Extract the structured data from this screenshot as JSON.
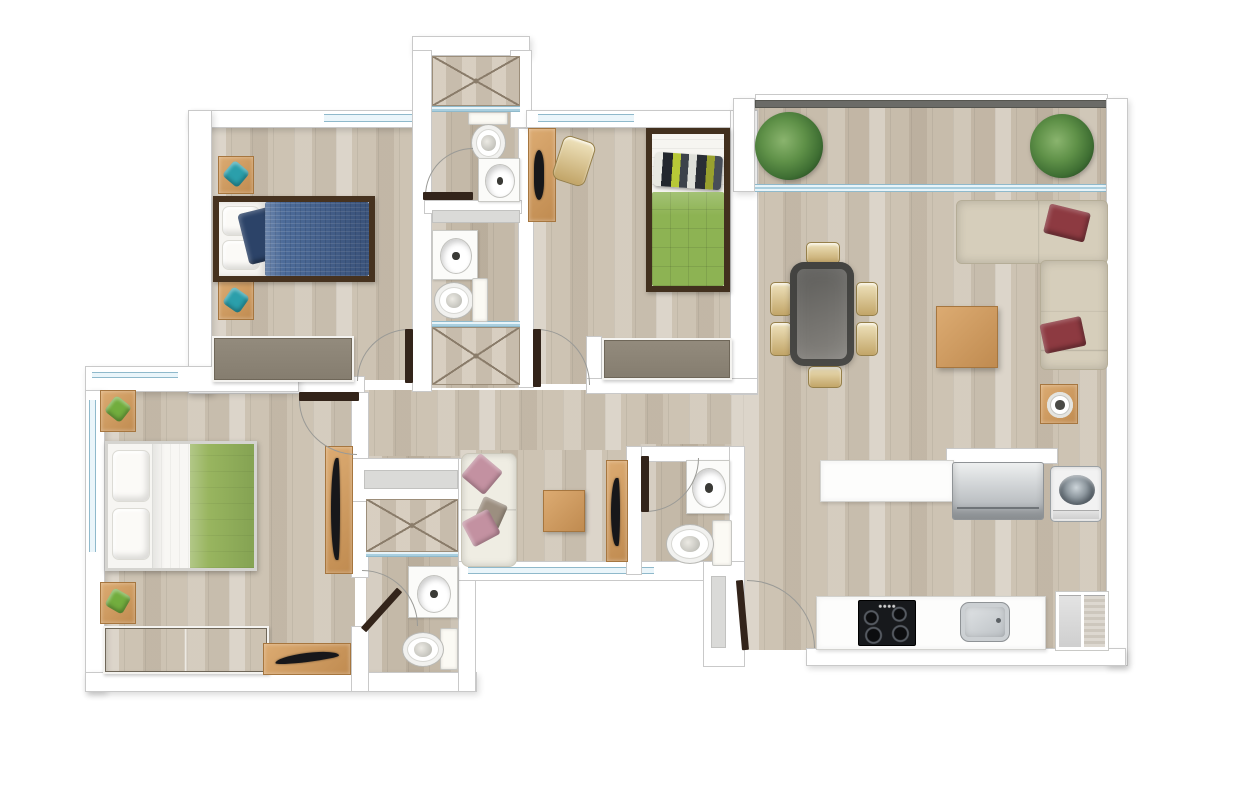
{
  "scene": {
    "type": "apartment-floor-plan",
    "view": "top-down-render",
    "text_labels": [],
    "rooms": [
      {
        "name": "bedroom-1",
        "furniture": [
          "single-bed-blue",
          "nightstand-teal-cushion-x2",
          "wardrobe-gray"
        ]
      },
      {
        "name": "bathroom-upper",
        "furniture": [
          "shower",
          "toilet",
          "sink-vanity"
        ]
      },
      {
        "name": "bathroom-lower",
        "furniture": [
          "sink-vanity",
          "toilet",
          "shower",
          "vent-window"
        ]
      },
      {
        "name": "bedroom-2",
        "furniture": [
          "single-bed-green",
          "desk-with-laptop",
          "chair-gold",
          "wardrobe-gray"
        ]
      },
      {
        "name": "living-dining",
        "furniture": [
          "dining-table-dark-glass",
          "dining-chairs-x6",
          "l-shaped-sofa-beige",
          "burgundy-pillows-x2",
          "coffee-table-wood",
          "side-table-with-tray"
        ]
      },
      {
        "name": "balcony",
        "furniture": [
          "plant-x2",
          "railing",
          "sliding-glass-door"
        ]
      },
      {
        "name": "master-bedroom",
        "furniture": [
          "double-bed-green-white",
          "nightstand-green-cushion-x2",
          "wardrobe-gray-two-door",
          "desk-with-tv",
          "tv-cabinet"
        ]
      },
      {
        "name": "master-bathroom",
        "furniture": [
          "shower",
          "sink-vanity",
          "toilet",
          "vent-window"
        ]
      },
      {
        "name": "hallway-lounge",
        "furniture": [
          "loveseat-white-pink-pillows",
          "square-side-table",
          "tv-cabinet-with-tv"
        ]
      },
      {
        "name": "guest-bathroom",
        "furniture": [
          "sink-vanity",
          "toilet",
          "vent-window"
        ]
      },
      {
        "name": "kitchen",
        "furniture": [
          "counter-island",
          "fridge-stainless",
          "washing-machine-toploader",
          "counter-with-cooktop-and-sink",
          "pantry-two-door"
        ]
      },
      {
        "name": "entrance",
        "furniture": [
          "entry-door"
        ]
      }
    ],
    "doors": [
      "bedroom-1-door",
      "bedroom-2-door",
      "upper-bathroom-door",
      "master-bedroom-door",
      "master-bathroom-door",
      "guest-bathroom-door",
      "entry-door"
    ],
    "windows": [
      "bedroom-1-top-window",
      "bedroom-2-top-window",
      "master-left-window",
      "master-top-window",
      "hall-bottom-window",
      "balcony-glass-wall"
    ]
  },
  "colors": {
    "wall": "#ffffff",
    "wall_line": "#c9c9c9",
    "floor_wood": "#cdc3b3",
    "floor_bath": "#c4b9a8",
    "floor_balcony": "#c7bcab",
    "door_leaf": "#33241a",
    "railing": "#6b6b67",
    "cushion_teal": "#2b9fab",
    "cushion_green": "#72ad3e",
    "duvet_blue": "#4c6b99",
    "pillow_navy": "#2c4368",
    "duvet_green": "#8db353",
    "duvet_master": "#98b55f",
    "bed_frame_dark": "#46321f",
    "sofa": "#d6cebb",
    "pillow_burgundy": "#8d3a41",
    "loveseat": "#efede3",
    "pillow_pink": "#c391a1",
    "chair_gold": "#cdb47c",
    "table_glass": "#6f6e6b",
    "wood": "#cf9c62",
    "closet_gray": "#8d8577",
    "glass": "#a9cfdf",
    "steel": "#c6cacd",
    "appliance_black": "#17191c",
    "plant_green": "#558540"
  }
}
